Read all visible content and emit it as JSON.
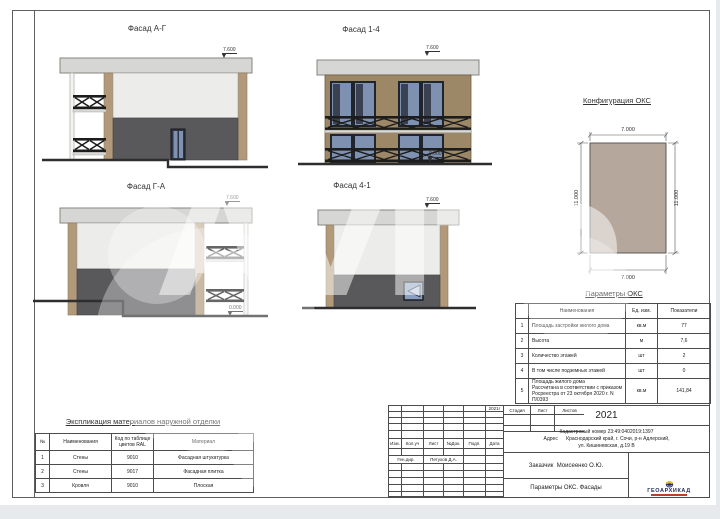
{
  "watermark": {
    "text": "Avito"
  },
  "facades": [
    {
      "title": "Фасад А-Г",
      "top_mark": "7.600"
    },
    {
      "title": "Фасад 1-4",
      "top_mark": "7.600",
      "bottom_mark": "0.000"
    },
    {
      "title": "Фасад Г-А",
      "top_mark": "7.600",
      "bottom_mark": "0.000"
    },
    {
      "title": "Фасад 4-1",
      "top_mark": "7.600"
    }
  ],
  "configuration": {
    "title": "Конфигурация ОКС",
    "width_dim": "7.000",
    "depth_dim": "11.000"
  },
  "parameters": {
    "title": "Параметры ОКС",
    "headers": {
      "name": "Наименования",
      "unit": "Ед. изм.",
      "value": "Показатели"
    },
    "rows": [
      {
        "n": "1",
        "name": "Площадь застройки жилого дома",
        "unit": "кв.м",
        "value": "77"
      },
      {
        "n": "2",
        "name": "Высота",
        "unit": "м",
        "value": "7,6"
      },
      {
        "n": "3",
        "name": "Количество этажей",
        "unit": "шт",
        "value": "2"
      },
      {
        "n": "4",
        "name": "В том числе  подземных этажей",
        "unit": "шт",
        "value": "0"
      },
      {
        "n": "5",
        "name": "Площадь жилого дома\nРассчитана в соответствии с приказом\nРосреестра от 23 октября 2020 г. N П/0393",
        "unit": "кв.м",
        "value": "141,84"
      }
    ]
  },
  "explication": {
    "title": "Экспликация материалов наружной отделки",
    "headers": {
      "n": "№",
      "name": "Наименования",
      "code": "Код по таблице цветов RAL",
      "material": "Материал"
    },
    "rows": [
      {
        "n": "1",
        "name": "Стены",
        "code": "9010",
        "material": "Фасадная штукатурка"
      },
      {
        "n": "2",
        "name": "Стены",
        "code": "9017",
        "material": "Фасадная плитка"
      },
      {
        "n": "3",
        "name": "Кровля",
        "code": "9010",
        "material": "Плоская"
      }
    ]
  },
  "titleblock": {
    "year_small": "2021г",
    "year": "2021",
    "cadastral": "Кадастровый номер 23:49:0402019:1397",
    "address": "Адрес      Краснодарский край, г. Сочи, р-н Адлерский,\nул. Кишиневская, д.19 В",
    "sig_headers": [
      "Изм.",
      "Кол.уч",
      "Лист",
      "№Док.",
      "Подп.",
      "Дата"
    ],
    "role": "Ген.дир.",
    "role_name": "Петухов Д.А.",
    "client": "Заказчик  Моисеенко О.Ю.",
    "doc_title": "Параметры ОКС. Фасады",
    "stage_headers": [
      "Стадия",
      "Лист",
      "Листов"
    ],
    "logo": "ГЕОАРХИКАД"
  },
  "colors": {
    "roof": "#d6d6d4",
    "wall_light": "#ececea",
    "wall_dark": "#59595b",
    "wall_tan": "#b1997a",
    "wall_brown": "#9c8767",
    "glass": "#7e91b0",
    "plan_fill": "#b5a79c",
    "logo_navy": "#203055",
    "logo_red": "#c23b2e"
  }
}
